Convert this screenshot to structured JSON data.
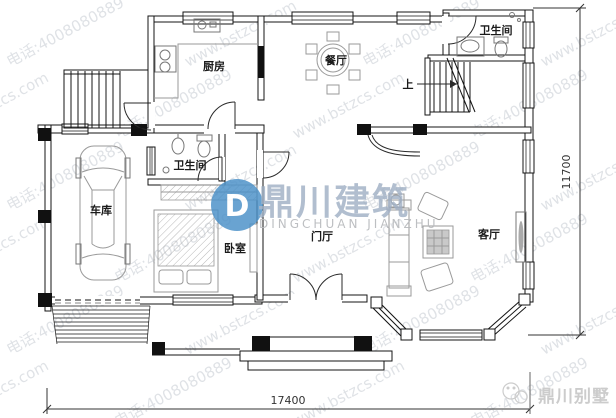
{
  "watermark": {
    "line1": "www.bstzcs.com",
    "line2": "电话:4008080889",
    "color": "#c6cbd2"
  },
  "logo": {
    "mark": "D",
    "name_cn": "鼎川建筑",
    "name_en": "DINGCHUAN JIANZHU",
    "color": "#4a90c8"
  },
  "brand_footer": {
    "text": "鼎川别墅"
  },
  "rooms": {
    "kitchen": "厨房",
    "dining": "餐厅",
    "bath_top": "卫生间",
    "bath_mid": "卫生间",
    "bedroom": "卧室",
    "garage": "车库",
    "hall": "门厅",
    "living": "客厅",
    "stairs_up": "上"
  },
  "dimensions": {
    "width": "17400",
    "height": "11700"
  }
}
